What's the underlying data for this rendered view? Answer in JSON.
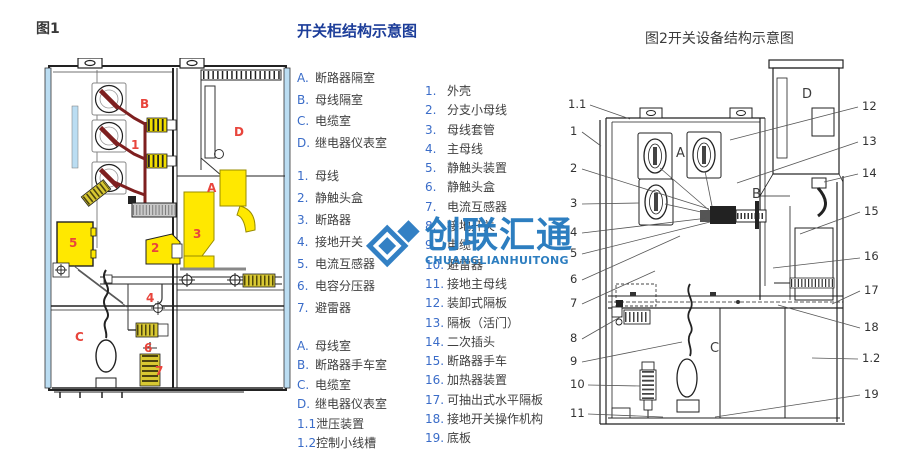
{
  "header": {
    "fig1_caption": "图1",
    "center_title": "开关柜结构示意图",
    "fig2_caption": "图2开关设备结构示意图"
  },
  "legend_left": {
    "compartments": [
      {
        "num": "A.",
        "label": "断路器隔室"
      },
      {
        "num": "B.",
        "label": "母线隔室"
      },
      {
        "num": "C.",
        "label": "电缆室"
      },
      {
        "num": "D.",
        "label": "继电器仪表室"
      }
    ],
    "parts": [
      {
        "num": "1.",
        "label": "母线"
      },
      {
        "num": "2.",
        "label": "静触头盒"
      },
      {
        "num": "3.",
        "label": "断路器"
      },
      {
        "num": "4.",
        "label": "接地开关"
      },
      {
        "num": "5.",
        "label": "电流互感器"
      },
      {
        "num": "6.",
        "label": "电容分压器"
      },
      {
        "num": "7.",
        "label": "避雷器"
      }
    ],
    "rooms": [
      {
        "num": "A.",
        "label": "母线室"
      },
      {
        "num": "B.",
        "label": "断路器手车室"
      },
      {
        "num": "C.",
        "label": "电缆室"
      },
      {
        "num": "D.",
        "label": "继电器仪表室"
      },
      {
        "num": "1.1",
        "label": "泄压装置"
      },
      {
        "num": "1.2",
        "label": "控制小线槽"
      }
    ]
  },
  "legend_right": {
    "parts": [
      {
        "num": "1.",
        "label": "外壳"
      },
      {
        "num": "2.",
        "label": "分支小母线"
      },
      {
        "num": "3.",
        "label": "母线套管"
      },
      {
        "num": "4.",
        "label": "主母线"
      },
      {
        "num": "5.",
        "label": "静触头装置"
      },
      {
        "num": "6.",
        "label": "静触头盒"
      },
      {
        "num": "7.",
        "label": "电流互感器"
      },
      {
        "num": "8.",
        "label": "接地开关"
      },
      {
        "num": "9.",
        "label": "电缆"
      },
      {
        "num": "10.",
        "label": "避雷器"
      },
      {
        "num": "11.",
        "label": "接地主母线"
      },
      {
        "num": "12.",
        "label": "装卸式隔板"
      },
      {
        "num": "13.",
        "label": "隔板（活门）"
      },
      {
        "num": "14.",
        "label": "二次插头"
      },
      {
        "num": "15.",
        "label": "断路器手车"
      },
      {
        "num": "16.",
        "label": "加热器装置"
      },
      {
        "num": "17.",
        "label": "可抽出式水平隔板"
      },
      {
        "num": "18.",
        "label": "接地开关操作机构"
      },
      {
        "num": "19.",
        "label": "底板"
      }
    ]
  },
  "watermark": {
    "cn": "创联汇通",
    "en": "CHUANGLIANHUITONG"
  },
  "fig1": {
    "labels": [
      "B",
      "1",
      "D",
      "A",
      "3",
      "2",
      "5",
      "4",
      "C",
      "6",
      "7"
    ]
  },
  "fig2": {
    "callouts_left": [
      "1.1",
      "1",
      "2",
      "3",
      "4",
      "5",
      "6",
      "7",
      "8",
      "9",
      "10",
      "11"
    ],
    "callouts_right": [
      "12",
      "13",
      "14",
      "15",
      "16",
      "17",
      "18",
      "1.2",
      "19"
    ],
    "regions": [
      "A",
      "B",
      "C",
      "D"
    ]
  },
  "colors": {
    "title_blue": "#1c3d99",
    "list_number_blue": "#3a6cc8",
    "watermark_blue": "#2579be",
    "label_red": "#e8453c",
    "busbar_maroon": "#7e1f1f",
    "part_yellow": "#ffe800",
    "coil_olive": "#d8c832",
    "edge_lightblue": "#bbddf2"
  }
}
